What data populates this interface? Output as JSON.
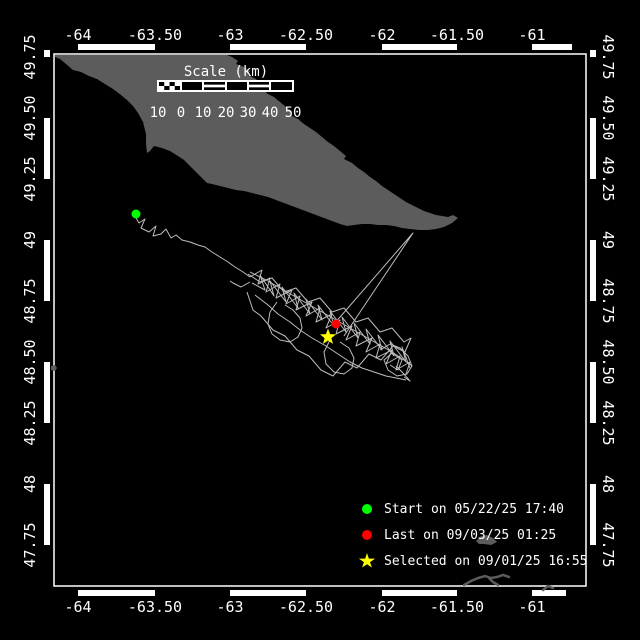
{
  "colors": {
    "background": "#000000",
    "frame": "#ffffff",
    "land": "#5c5c5c",
    "track": "#bdbdbd",
    "start_marker": "#00ff00",
    "last_marker": "#ff0000",
    "selected_marker": "#ffff00",
    "text": "#ffffff"
  },
  "axes": {
    "top": [
      {
        "text": "-64",
        "x": 78
      },
      {
        "text": "-63.50",
        "x": 155
      },
      {
        "text": "-63",
        "x": 230
      },
      {
        "text": "-62.50",
        "x": 306
      },
      {
        "text": "-62",
        "x": 382
      },
      {
        "text": "-61.50",
        "x": 457
      },
      {
        "text": "-61",
        "x": 532
      }
    ],
    "bottom": [
      {
        "text": "-64",
        "x": 78
      },
      {
        "text": "-63.50",
        "x": 155
      },
      {
        "text": "-63",
        "x": 230
      },
      {
        "text": "-62.50",
        "x": 306
      },
      {
        "text": "-62",
        "x": 382
      },
      {
        "text": "-61.50",
        "x": 457
      },
      {
        "text": "-61",
        "x": 532
      }
    ],
    "left": [
      {
        "text": "49.75",
        "y": 57
      },
      {
        "text": "49.50",
        "y": 118
      },
      {
        "text": "49.25",
        "y": 179
      },
      {
        "text": "49",
        "y": 240
      },
      {
        "text": "48.75",
        "y": 301
      },
      {
        "text": "48.50",
        "y": 362
      },
      {
        "text": "48.25",
        "y": 423
      },
      {
        "text": "48",
        "y": 484
      },
      {
        "text": "47.75",
        "y": 545
      }
    ],
    "right": [
      {
        "text": "49.75",
        "y": 57
      },
      {
        "text": "49.50",
        "y": 118
      },
      {
        "text": "49.25",
        "y": 179
      },
      {
        "text": "49",
        "y": 240
      },
      {
        "text": "48.75",
        "y": 301
      },
      {
        "text": "48.50",
        "y": 362
      },
      {
        "text": "48.25",
        "y": 423
      },
      {
        "text": "48",
        "y": 484
      },
      {
        "text": "47.75",
        "y": 545
      }
    ]
  },
  "frame": {
    "outer": [
      44,
      44,
      596,
      596
    ],
    "band": 6,
    "inner": [
      54,
      54,
      586,
      586
    ],
    "black_segments": {
      "top": [
        [
          44,
          78
        ],
        [
          155,
          230
        ],
        [
          306,
          382
        ],
        [
          457,
          532
        ],
        [
          572,
          596
        ]
      ],
      "bottom": [
        [
          44,
          78
        ],
        [
          155,
          230
        ],
        [
          306,
          382
        ],
        [
          457,
          532
        ],
        [
          566,
          596
        ]
      ],
      "left": [
        [
          57,
          118
        ],
        [
          179,
          240
        ],
        [
          301,
          362
        ],
        [
          423,
          484
        ],
        [
          545,
          596
        ]
      ],
      "right": [
        [
          57,
          118
        ],
        [
          179,
          240
        ],
        [
          301,
          362
        ],
        [
          423,
          484
        ],
        [
          545,
          596
        ]
      ]
    }
  },
  "scale_bar": {
    "title": "Scale (km)",
    "title_x": 226,
    "title_y": 64,
    "bar": {
      "x": 157,
      "y": 80,
      "w": 137,
      "h": 12
    },
    "segments": [
      {
        "x1": 158,
        "x2": 181,
        "style": "checker"
      },
      {
        "x1": 181,
        "x2": 203,
        "style": "solid"
      },
      {
        "x1": 203,
        "x2": 226,
        "style": "striped"
      },
      {
        "x1": 226,
        "x2": 248,
        "style": "solid"
      },
      {
        "x1": 248,
        "x2": 270,
        "style": "striped"
      },
      {
        "x1": 270,
        "x2": 293,
        "style": "solid"
      }
    ],
    "labels": [
      {
        "text": "10",
        "x": 158
      },
      {
        "text": "0",
        "x": 181
      },
      {
        "text": "10",
        "x": 203
      },
      {
        "text": "20",
        "x": 226
      },
      {
        "text": "30",
        "x": 248
      },
      {
        "text": "40",
        "x": 270
      },
      {
        "text": "50",
        "x": 293
      }
    ],
    "labels_y": 105
  },
  "legend": {
    "items": [
      {
        "marker": "circle",
        "color": "#00ff00",
        "label": "Start on 05/22/25 17:40"
      },
      {
        "marker": "circle",
        "color": "#ff0000",
        "label": "Last on 09/03/25 01:25"
      },
      {
        "marker": "star",
        "color": "#ffff00",
        "label": "Selected on 09/01/25 16:55"
      }
    ]
  },
  "markers": {
    "start": {
      "x": 136,
      "y": 214,
      "r": 4.5
    },
    "last": {
      "x": 336,
      "y": 324,
      "r": 4.5
    },
    "selected": {
      "x": 328,
      "y": 337,
      "r": 8.5
    }
  },
  "land_polygon": [
    [
      55,
      55
    ],
    [
      227,
      55
    ],
    [
      232,
      57
    ],
    [
      238,
      61
    ],
    [
      236,
      64
    ],
    [
      244,
      67
    ],
    [
      250,
      71
    ],
    [
      248,
      75
    ],
    [
      256,
      79
    ],
    [
      262,
      85
    ],
    [
      268,
      89
    ],
    [
      266,
      93
    ],
    [
      274,
      97
    ],
    [
      280,
      102
    ],
    [
      286,
      107
    ],
    [
      292,
      111
    ],
    [
      290,
      115
    ],
    [
      298,
      119
    ],
    [
      304,
      124
    ],
    [
      310,
      128
    ],
    [
      316,
      132
    ],
    [
      322,
      137
    ],
    [
      328,
      142
    ],
    [
      334,
      146
    ],
    [
      340,
      151
    ],
    [
      346,
      156
    ],
    [
      344,
      159
    ],
    [
      352,
      163
    ],
    [
      358,
      168
    ],
    [
      364,
      172
    ],
    [
      370,
      177
    ],
    [
      376,
      181
    ],
    [
      382,
      186
    ],
    [
      388,
      190
    ],
    [
      394,
      194
    ],
    [
      400,
      198
    ],
    [
      406,
      202
    ],
    [
      412,
      205
    ],
    [
      418,
      208
    ],
    [
      424,
      211
    ],
    [
      430,
      213
    ],
    [
      436,
      215
    ],
    [
      442,
      216
    ],
    [
      448,
      217
    ],
    [
      453,
      215
    ],
    [
      458,
      218
    ],
    [
      452,
      223
    ],
    [
      444,
      227
    ],
    [
      436,
      229
    ],
    [
      428,
      230
    ],
    [
      419,
      230
    ],
    [
      410,
      229
    ],
    [
      402,
      228
    ],
    [
      394,
      226
    ],
    [
      386,
      225
    ],
    [
      378,
      225
    ],
    [
      370,
      224
    ],
    [
      362,
      224
    ],
    [
      354,
      225
    ],
    [
      347,
      226
    ],
    [
      340,
      224
    ],
    [
      332,
      221
    ],
    [
      324,
      218
    ],
    [
      316,
      215
    ],
    [
      308,
      212
    ],
    [
      300,
      209
    ],
    [
      292,
      206
    ],
    [
      284,
      203
    ],
    [
      276,
      200
    ],
    [
      268,
      197
    ],
    [
      260,
      195
    ],
    [
      252,
      193
    ],
    [
      244,
      191
    ],
    [
      236,
      190
    ],
    [
      228,
      188
    ],
    [
      220,
      186
    ],
    [
      212,
      184
    ],
    [
      207,
      183
    ],
    [
      202,
      178
    ],
    [
      196,
      172
    ],
    [
      190,
      166
    ],
    [
      184,
      160
    ],
    [
      178,
      156
    ],
    [
      170,
      151
    ],
    [
      162,
      148
    ],
    [
      154,
      146
    ],
    [
      150,
      151
    ],
    [
      147,
      153
    ],
    [
      146,
      144
    ],
    [
      146,
      134
    ],
    [
      143,
      122
    ],
    [
      138,
      113
    ],
    [
      133,
      106
    ],
    [
      127,
      100
    ],
    [
      121,
      95
    ],
    [
      113,
      89
    ],
    [
      105,
      84
    ],
    [
      97,
      79
    ],
    [
      89,
      76
    ],
    [
      81,
      72
    ],
    [
      73,
      70
    ],
    [
      66,
      64
    ],
    [
      60,
      59
    ],
    [
      55,
      57
    ]
  ],
  "islands": {
    "fills": [
      [
        [
          51,
          366
        ],
        [
          55,
          365
        ],
        [
          57,
          368
        ],
        [
          55,
          371
        ],
        [
          51,
          370
        ]
      ],
      [
        [
          476,
          541
        ],
        [
          481,
          536
        ],
        [
          487,
          535
        ],
        [
          493,
          538
        ],
        [
          497,
          542
        ],
        [
          491,
          545
        ],
        [
          484,
          544
        ],
        [
          479,
          544
        ]
      ]
    ],
    "strokes": [
      [
        [
          464,
          585
        ],
        [
          471,
          581
        ],
        [
          478,
          578
        ],
        [
          485,
          576
        ],
        [
          491,
          578
        ],
        [
          497,
          577
        ],
        [
          503,
          575
        ],
        [
          509,
          577
        ]
      ],
      [
        [
          489,
          578
        ],
        [
          493,
          582
        ],
        [
          498,
          585
        ]
      ],
      [
        [
          543,
          590
        ],
        [
          548,
          586
        ],
        [
          553,
          588
        ]
      ]
    ]
  },
  "track_paths": [
    [
      [
        136,
        218
      ],
      [
        139,
        223
      ],
      [
        145,
        219
      ],
      [
        141,
        228
      ],
      [
        149,
        232
      ],
      [
        156,
        226
      ],
      [
        153,
        236
      ],
      [
        161,
        234
      ],
      [
        166,
        229
      ],
      [
        171,
        238
      ],
      [
        176,
        235
      ],
      [
        182,
        240
      ],
      [
        190,
        242
      ],
      [
        198,
        245
      ],
      [
        205,
        247
      ],
      [
        212,
        252
      ],
      [
        220,
        257
      ],
      [
        228,
        262
      ],
      [
        235,
        267
      ],
      [
        243,
        272
      ],
      [
        250,
        277
      ]
    ],
    [
      [
        250,
        272
      ],
      [
        266,
        280
      ],
      [
        280,
        288
      ],
      [
        294,
        296
      ],
      [
        308,
        304
      ],
      [
        322,
        312
      ],
      [
        336,
        320
      ],
      [
        350,
        328
      ],
      [
        364,
        336
      ],
      [
        378,
        344
      ],
      [
        392,
        352
      ],
      [
        404,
        360
      ],
      [
        412,
        366
      ]
    ],
    [
      [
        255,
        295
      ],
      [
        268,
        305
      ],
      [
        278,
        314
      ],
      [
        290,
        322
      ],
      [
        300,
        330
      ],
      [
        312,
        338
      ],
      [
        326,
        346
      ],
      [
        338,
        354
      ],
      [
        350,
        362
      ],
      [
        362,
        368
      ],
      [
        374,
        372
      ],
      [
        386,
        376
      ],
      [
        396,
        378
      ],
      [
        406,
        380
      ]
    ],
    [
      [
        250,
        277
      ],
      [
        262,
        270
      ],
      [
        258,
        284
      ],
      [
        270,
        278
      ],
      [
        266,
        292
      ],
      [
        280,
        284
      ],
      [
        276,
        298
      ],
      [
        292,
        290
      ],
      [
        286,
        304
      ],
      [
        300,
        296
      ],
      [
        296,
        310
      ],
      [
        312,
        302
      ],
      [
        306,
        316
      ],
      [
        320,
        308
      ],
      [
        316,
        322
      ],
      [
        332,
        314
      ],
      [
        326,
        328
      ],
      [
        340,
        320
      ],
      [
        336,
        334
      ],
      [
        352,
        326
      ],
      [
        346,
        340
      ],
      [
        360,
        332
      ],
      [
        356,
        346
      ],
      [
        372,
        338
      ],
      [
        366,
        352
      ],
      [
        380,
        344
      ],
      [
        376,
        358
      ],
      [
        392,
        350
      ],
      [
        386,
        364
      ],
      [
        400,
        356
      ],
      [
        396,
        370
      ],
      [
        410,
        362
      ],
      [
        406,
        374
      ]
    ],
    [
      [
        252,
        283
      ],
      [
        265,
        290
      ],
      [
        260,
        275
      ],
      [
        274,
        296
      ],
      [
        270,
        281
      ],
      [
        286,
        302
      ],
      [
        282,
        287
      ],
      [
        298,
        308
      ],
      [
        294,
        293
      ],
      [
        310,
        314
      ],
      [
        306,
        299
      ],
      [
        322,
        320
      ],
      [
        318,
        305
      ],
      [
        334,
        326
      ],
      [
        330,
        311
      ],
      [
        346,
        332
      ],
      [
        342,
        317
      ],
      [
        358,
        338
      ],
      [
        354,
        323
      ],
      [
        370,
        344
      ],
      [
        366,
        329
      ],
      [
        382,
        350
      ],
      [
        378,
        335
      ],
      [
        394,
        356
      ],
      [
        390,
        341
      ],
      [
        406,
        362
      ],
      [
        402,
        347
      ],
      [
        410,
        368
      ]
    ],
    [
      [
        248,
        274
      ],
      [
        260,
        282
      ],
      [
        272,
        278
      ],
      [
        284,
        292
      ],
      [
        296,
        288
      ],
      [
        308,
        302
      ],
      [
        320,
        298
      ],
      [
        332,
        312
      ],
      [
        344,
        308
      ],
      [
        356,
        322
      ],
      [
        368,
        318
      ],
      [
        380,
        332
      ],
      [
        392,
        328
      ],
      [
        404,
        342
      ],
      [
        411,
        338
      ],
      [
        405,
        352
      ],
      [
        393,
        346
      ],
      [
        381,
        360
      ],
      [
        369,
        354
      ],
      [
        357,
        368
      ],
      [
        345,
        362
      ],
      [
        333,
        376
      ],
      [
        321,
        370
      ],
      [
        309,
        356
      ],
      [
        297,
        350
      ],
      [
        285,
        336
      ],
      [
        273,
        330
      ],
      [
        261,
        316
      ],
      [
        253,
        310
      ],
      [
        247,
        292
      ]
    ],
    [
      [
        277,
        302
      ],
      [
        270,
        312
      ],
      [
        268,
        324
      ],
      [
        272,
        334
      ],
      [
        280,
        340
      ],
      [
        290,
        342
      ],
      [
        298,
        337
      ],
      [
        302,
        328
      ],
      [
        300,
        318
      ],
      [
        293,
        310
      ],
      [
        285,
        305
      ]
    ],
    [
      [
        330,
        340
      ],
      [
        324,
        352
      ],
      [
        326,
        364
      ],
      [
        334,
        372
      ],
      [
        344,
        374
      ],
      [
        352,
        368
      ],
      [
        354,
        358
      ],
      [
        349,
        348
      ],
      [
        340,
        342
      ]
    ],
    [
      [
        380,
        350
      ],
      [
        390,
        344
      ],
      [
        400,
        348
      ],
      [
        408,
        356
      ],
      [
        412,
        366
      ],
      [
        407,
        374
      ],
      [
        397,
        376
      ],
      [
        388,
        370
      ],
      [
        384,
        360
      ],
      [
        392,
        353
      ],
      [
        402,
        360
      ],
      [
        398,
        370
      ],
      [
        390,
        365
      ]
    ],
    [
      [
        334,
        324
      ],
      [
        413,
        233
      ],
      [
        344,
        336
      ]
    ],
    [
      [
        396,
        366
      ],
      [
        404,
        374
      ],
      [
        410,
        381
      ],
      [
        404,
        377
      ]
    ],
    [
      [
        250,
        282
      ],
      [
        241,
        287
      ],
      [
        233,
        283
      ],
      [
        230,
        281
      ]
    ]
  ]
}
